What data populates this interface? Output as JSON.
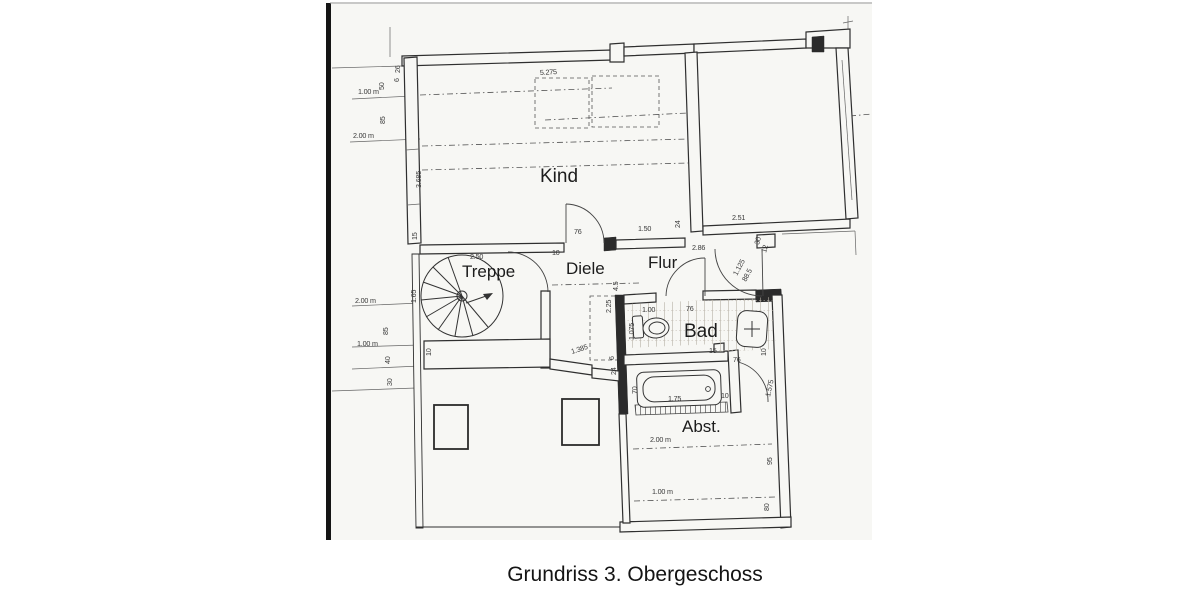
{
  "caption": "Grundriss 3. Obergeschoss",
  "colors": {
    "paper": "#f7f7f4",
    "ink": "#2f2f2f",
    "scan_edge": "#151515"
  },
  "plan": {
    "rooms": [
      {
        "label": "Kind",
        "x": 540,
        "y": 182,
        "s": 19
      },
      {
        "label": "Treppe",
        "x": 462,
        "y": 277,
        "s": 17
      },
      {
        "label": "Diele",
        "x": 566,
        "y": 274,
        "s": 17
      },
      {
        "label": "Flur",
        "x": 648,
        "y": 268,
        "s": 17
      },
      {
        "label": "Bad",
        "x": 684,
        "y": 337,
        "s": 19
      },
      {
        "label": "Abst.",
        "x": 682,
        "y": 432,
        "s": 17
      }
    ],
    "dimensions": [
      {
        "t": "5.275",
        "x": 540,
        "y": 75,
        "r": -3
      },
      {
        "t": "1.00 m",
        "x": 358,
        "y": 94,
        "s": 7.8
      },
      {
        "t": "50",
        "x": 384,
        "y": 90,
        "r": -90
      },
      {
        "t": "85",
        "x": 385,
        "y": 124,
        "r": -90
      },
      {
        "t": "2.00 m",
        "x": 353,
        "y": 138,
        "s": 7.8
      },
      {
        "t": "26",
        "x": 400,
        "y": 73,
        "r": -90
      },
      {
        "t": "6",
        "x": 399,
        "y": 82,
        "r": -90
      },
      {
        "t": "3.685",
        "x": 421,
        "y": 188,
        "r": -90
      },
      {
        "t": "15",
        "x": 417,
        "y": 240,
        "r": -90
      },
      {
        "t": "2.50",
        "x": 470,
        "y": 259
      },
      {
        "t": "10",
        "x": 552,
        "y": 255
      },
      {
        "t": "76",
        "x": 574,
        "y": 234
      },
      {
        "t": "1.50",
        "x": 638,
        "y": 231
      },
      {
        "t": "24",
        "x": 680,
        "y": 228,
        "r": -90
      },
      {
        "t": "2.86",
        "x": 692,
        "y": 250
      },
      {
        "t": "2.51",
        "x": 732,
        "y": 220
      },
      {
        "t": "30",
        "x": 759,
        "y": 245,
        "r": -75
      },
      {
        "t": "12",
        "x": 766,
        "y": 253,
        "r": -75
      },
      {
        "t": "1.125",
        "x": 737,
        "y": 276,
        "r": -62
      },
      {
        "t": "88.5",
        "x": 746,
        "y": 282,
        "r": -62
      },
      {
        "t": "1.65",
        "x": 416,
        "y": 303,
        "r": -90
      },
      {
        "t": "2.00 m",
        "x": 355,
        "y": 303,
        "s": 7.8
      },
      {
        "t": "85",
        "x": 388,
        "y": 335,
        "r": -90
      },
      {
        "t": "1.00 m",
        "x": 357,
        "y": 346,
        "s": 7.8
      },
      {
        "t": "40",
        "x": 390,
        "y": 364,
        "r": -90
      },
      {
        "t": "30",
        "x": 392,
        "y": 386,
        "r": -90
      },
      {
        "t": "10",
        "x": 431,
        "y": 356,
        "r": -90
      },
      {
        "t": "4.5",
        "x": 618,
        "y": 291,
        "r": -90
      },
      {
        "t": "2.25",
        "x": 611,
        "y": 313,
        "r": -90
      },
      {
        "t": "1.385",
        "x": 572,
        "y": 354,
        "r": -18
      },
      {
        "t": "6",
        "x": 614,
        "y": 360,
        "r": -90
      },
      {
        "t": "24",
        "x": 616,
        "y": 375,
        "r": -90
      },
      {
        "t": "1.00",
        "x": 642,
        "y": 312
      },
      {
        "t": "1.075",
        "x": 634,
        "y": 340,
        "r": -90
      },
      {
        "t": "76",
        "x": 686,
        "y": 311
      },
      {
        "t": "15",
        "x": 709,
        "y": 353
      },
      {
        "t": "76",
        "x": 733,
        "y": 362
      },
      {
        "t": "10",
        "x": 766,
        "y": 356,
        "r": -90
      },
      {
        "t": "1.575",
        "x": 770,
        "y": 397,
        "r": -78
      },
      {
        "t": "70",
        "x": 637,
        "y": 394,
        "r": -90
      },
      {
        "t": "1.75",
        "x": 668,
        "y": 401
      },
      {
        "t": "10",
        "x": 721,
        "y": 398
      },
      {
        "t": "2.00 m",
        "x": 650,
        "y": 442,
        "s": 7.8
      },
      {
        "t": "1.00 m",
        "x": 652,
        "y": 494,
        "s": 7.8
      },
      {
        "t": "95",
        "x": 772,
        "y": 465,
        "r": -90
      },
      {
        "t": "80",
        "x": 769,
        "y": 511,
        "r": -90
      }
    ]
  }
}
